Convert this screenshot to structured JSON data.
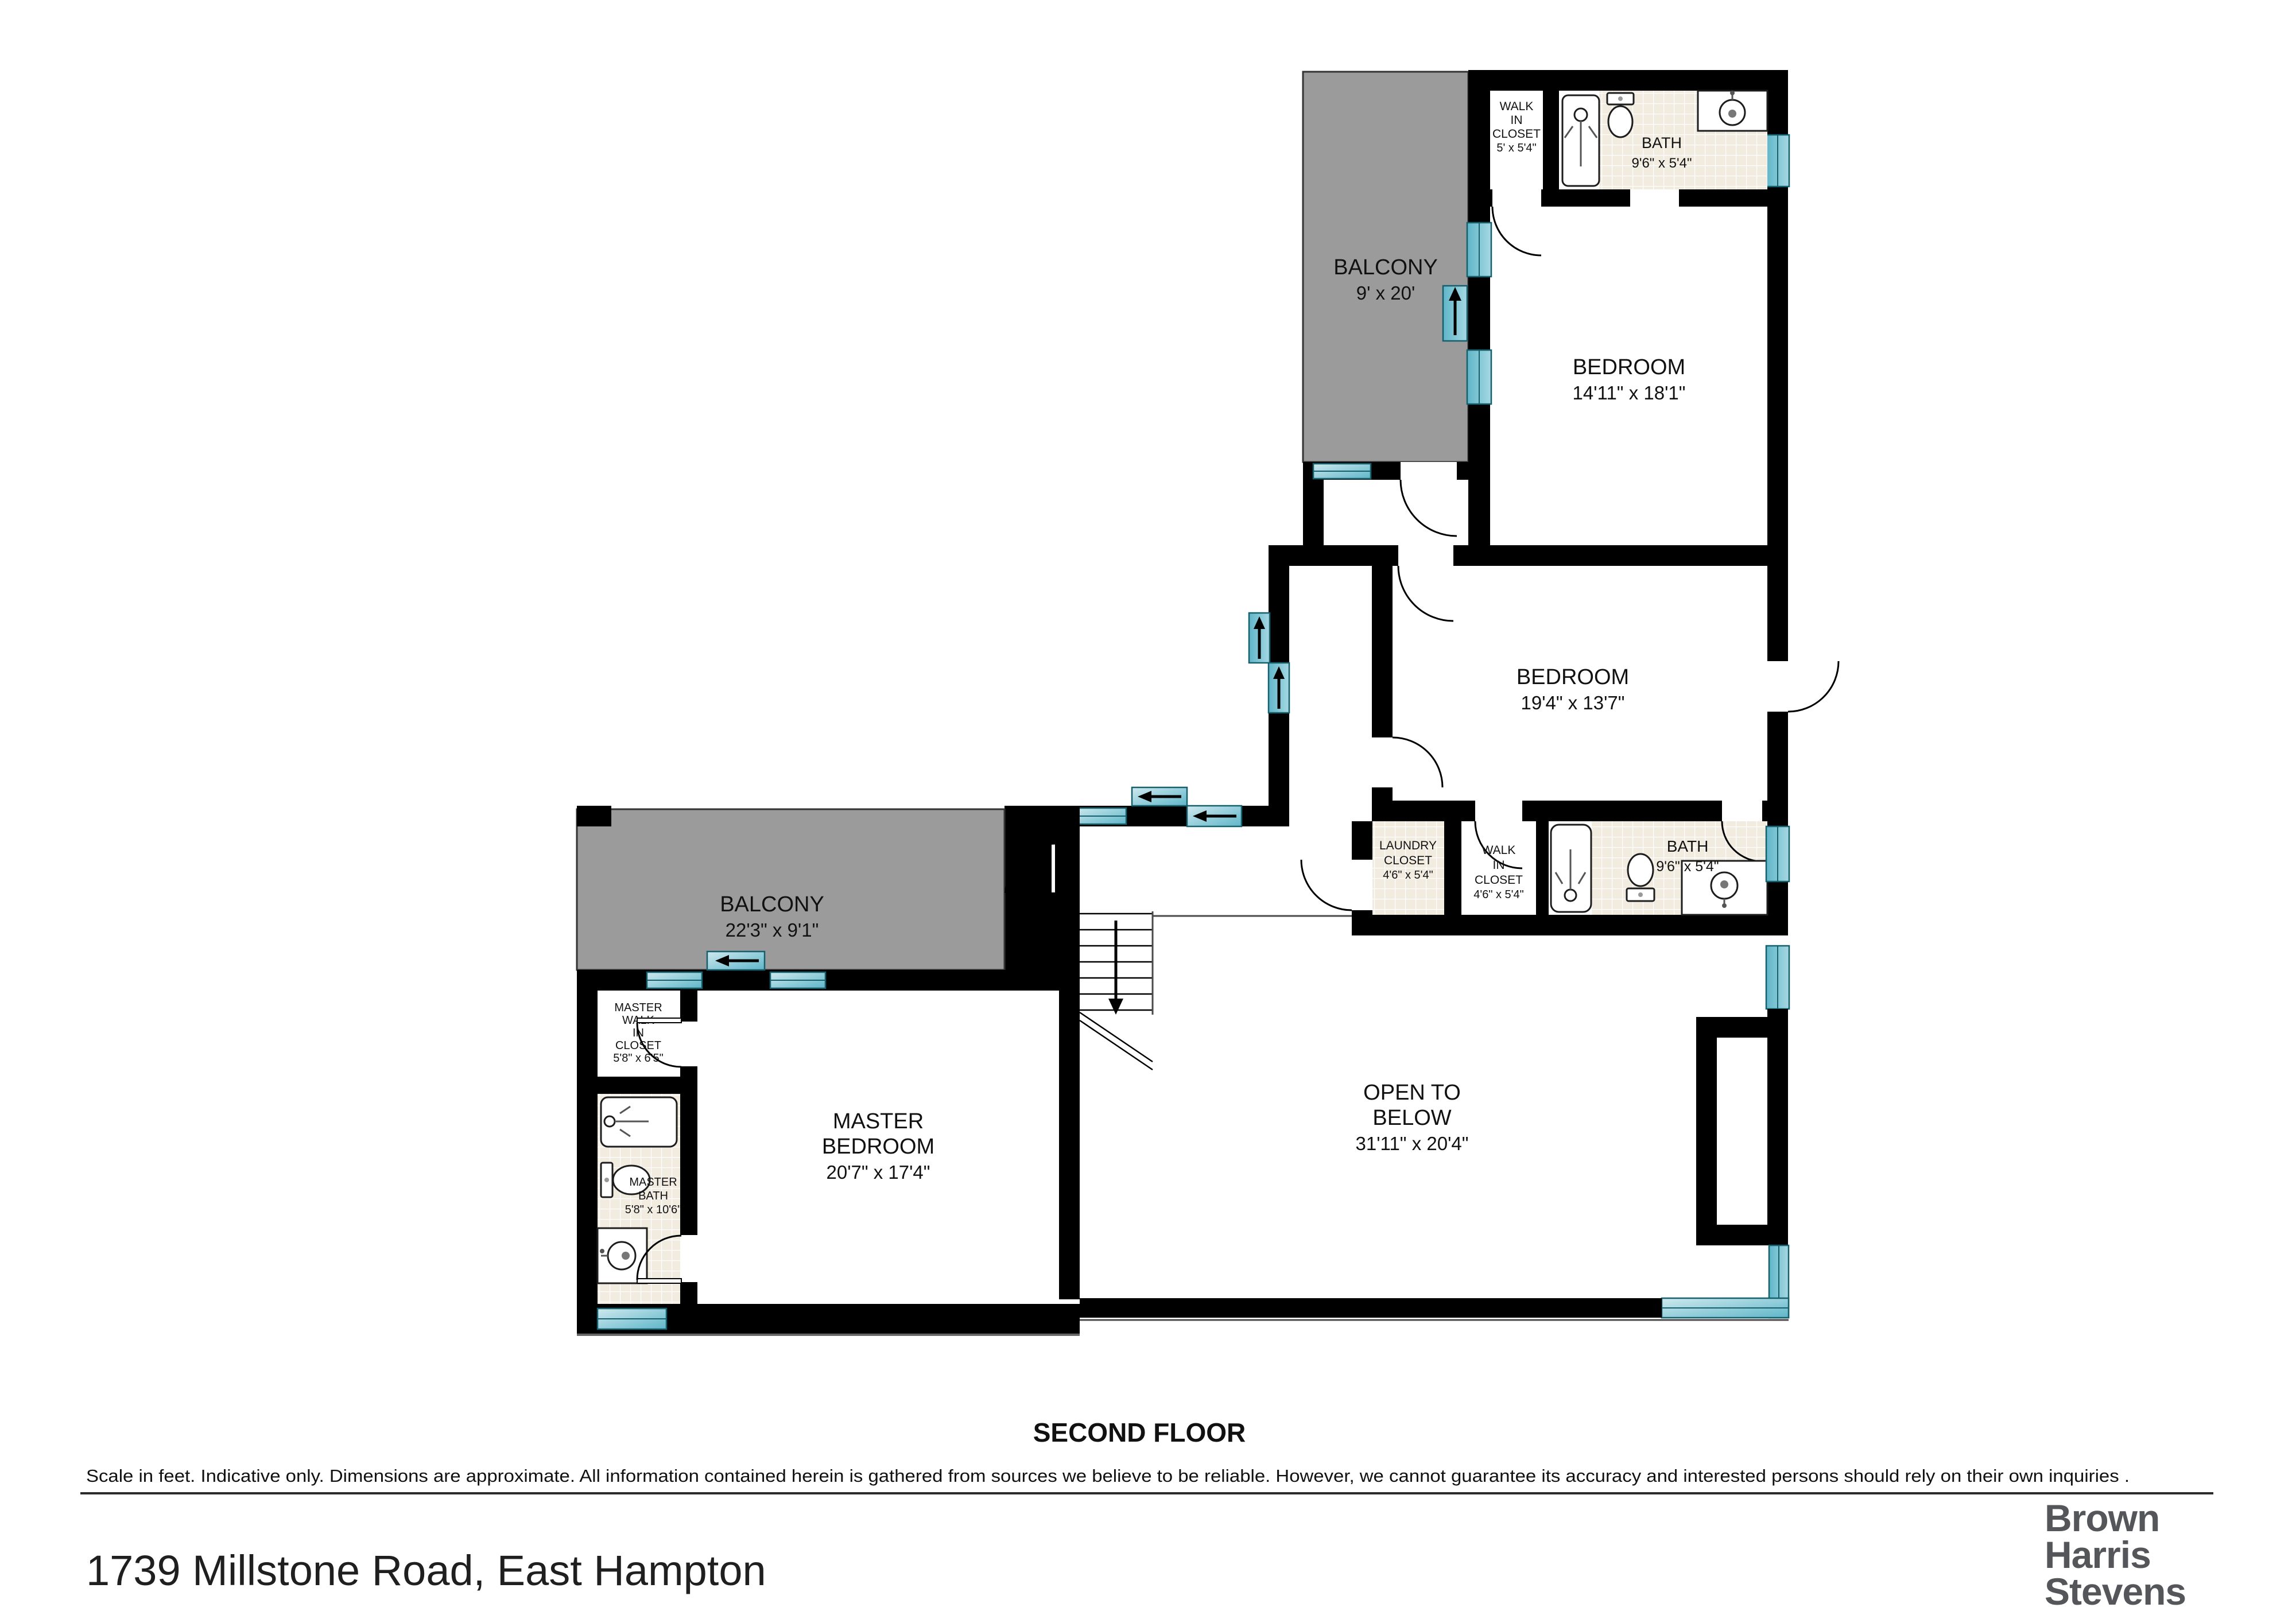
{
  "floorplan": {
    "title": "SECOND FLOOR",
    "address": "1739 Millstone Road, East Hampton",
    "disclaimer": "Scale in feet. Indicative only. Dimensions are approximate. All information contained herein is gathered from sources we believe to be reliable. However, we cannot guarantee its accuracy and interested persons should rely on their own  inquiries .",
    "brand": {
      "l1": "Brown",
      "l2": "Harris",
      "l3": "Stevens"
    },
    "colors": {
      "wall": "#000000",
      "window": "#5fb6c9",
      "balcony": "#9b9b9b",
      "tile": "#f2ebdf",
      "logo": "#55565a"
    },
    "rooms": {
      "balcony_top": {
        "name": "BALCONY",
        "dims": "9' x 20'"
      },
      "closet_top": {
        "l1": "WALK",
        "l2": "IN",
        "l3": "CLOSET",
        "dims": "5' x 5'4\""
      },
      "bath_top": {
        "name": "BATH",
        "dims": "9'6\" x 5'4\""
      },
      "bedroom_top": {
        "name": "BEDROOM",
        "dims": "14'11\" x 18'1\""
      },
      "bedroom_mid": {
        "name": "BEDROOM",
        "dims": "19'4\" x 13'7\""
      },
      "laundry": {
        "l1": "LAUNDRY",
        "l2": "CLOSET",
        "dims": "4'6\" x 5'4\""
      },
      "closet_mid": {
        "l1": "WALK",
        "l2": "IN",
        "l3": "CLOSET",
        "dims": "4'6\" x 5'4\""
      },
      "bath_mid": {
        "name": "BATH",
        "dims": "9'6\" x 5'4\""
      },
      "balcony_left": {
        "name": "BALCONY",
        "dims": "22'3\" x 9'1\""
      },
      "master_closet": {
        "l1": "MASTER",
        "l2": "WALK",
        "l3": "IN",
        "l4": "CLOSET",
        "dims": "5'8\" x 6'5\""
      },
      "master_bedroom": {
        "l1": "MASTER",
        "l2": "BEDROOM",
        "dims": "20'7\" x 17'4\""
      },
      "master_bath": {
        "l1": "MASTER",
        "l2": "BATH",
        "dims": "5'8\" x 10'6\""
      },
      "open_below": {
        "l1": "OPEN TO",
        "l2": "BELOW",
        "dims": "31'11\" x 20'4\""
      }
    }
  }
}
